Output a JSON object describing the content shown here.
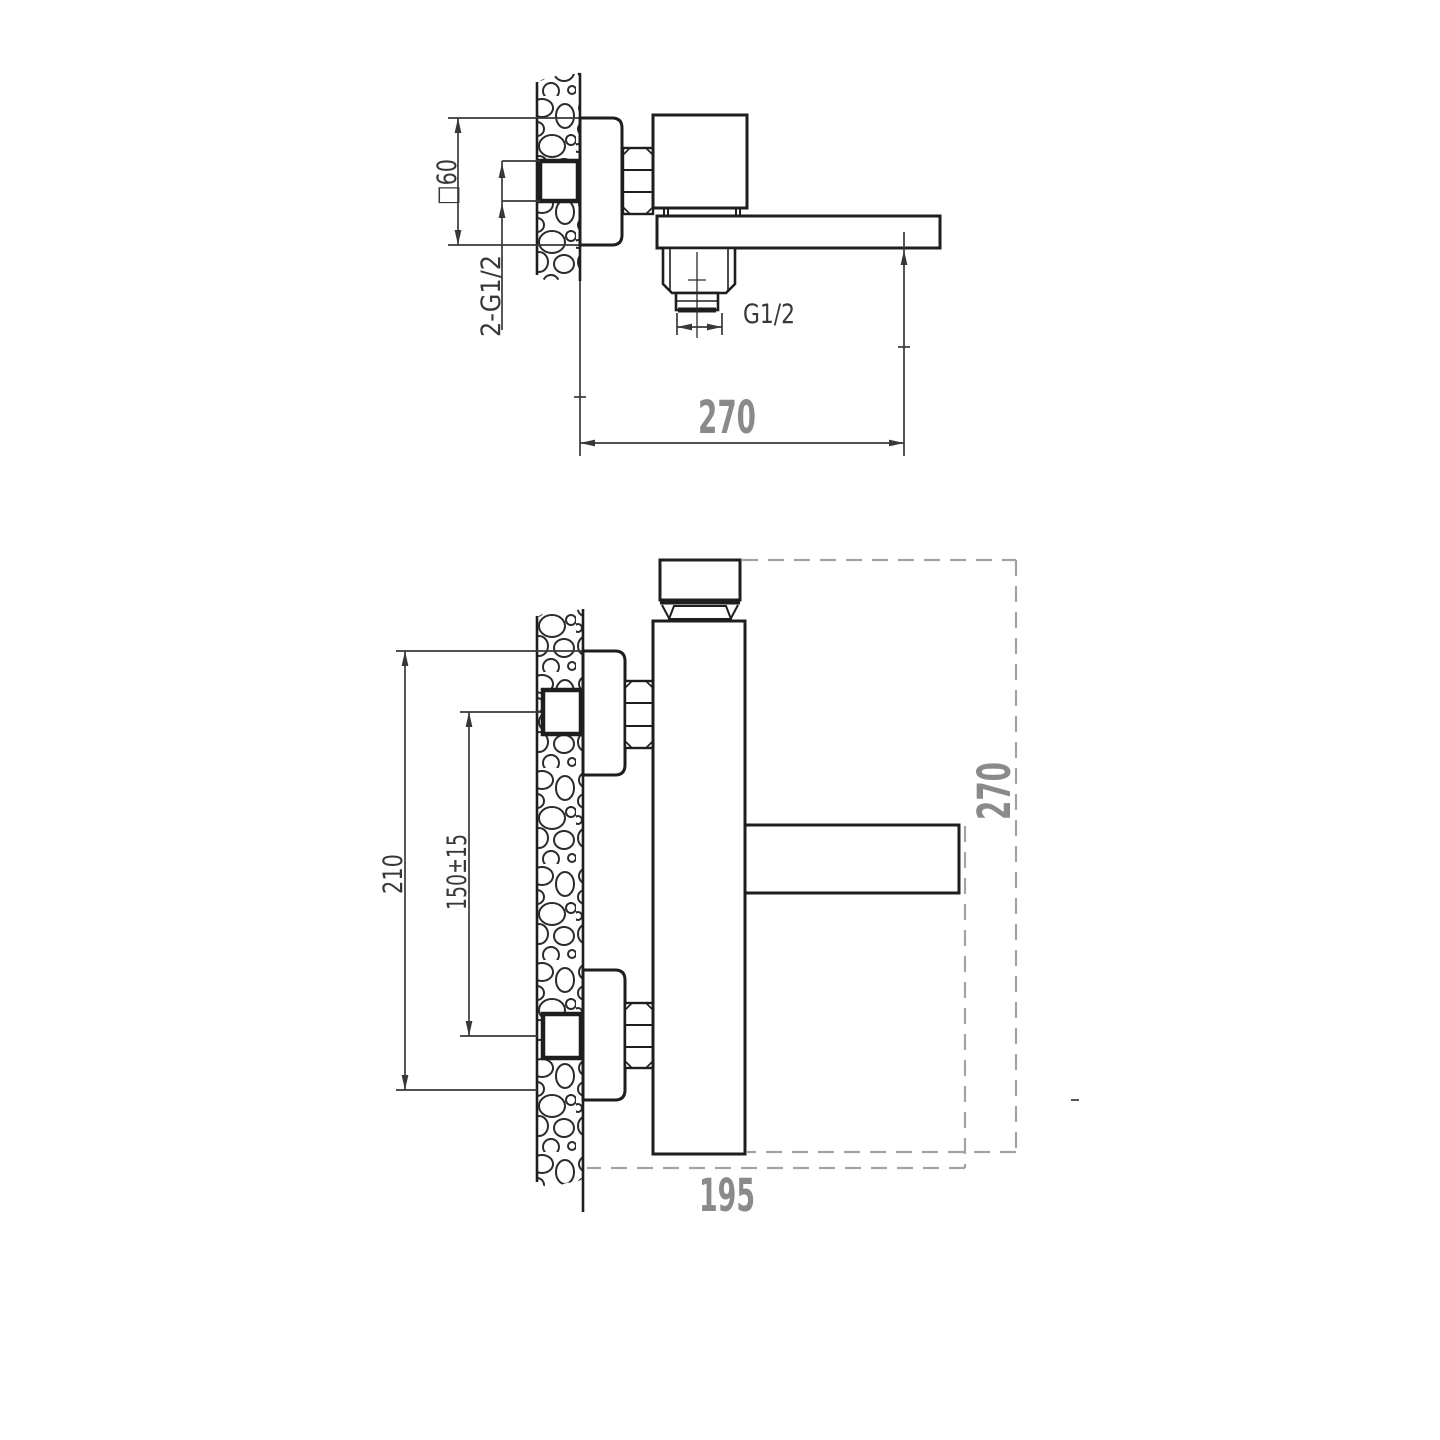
{
  "drawing": {
    "type": "faucet-installation-technical-drawing",
    "side_view": {
      "escutcheon_size": "□60",
      "inlet_thread": "2-G1/2",
      "outlet_thread": "G1/2",
      "spout_reach": "270"
    },
    "front_view": {
      "overall_height": "210",
      "inlet_spacing": "150±15",
      "height_envelope": "270",
      "projection": "195"
    },
    "colors": {
      "line": "#1e1e1e",
      "dimension": "#383838",
      "gray_text": "#8a8a8a",
      "dashed": "#a3a3a3",
      "background": "#ffffff"
    }
  }
}
